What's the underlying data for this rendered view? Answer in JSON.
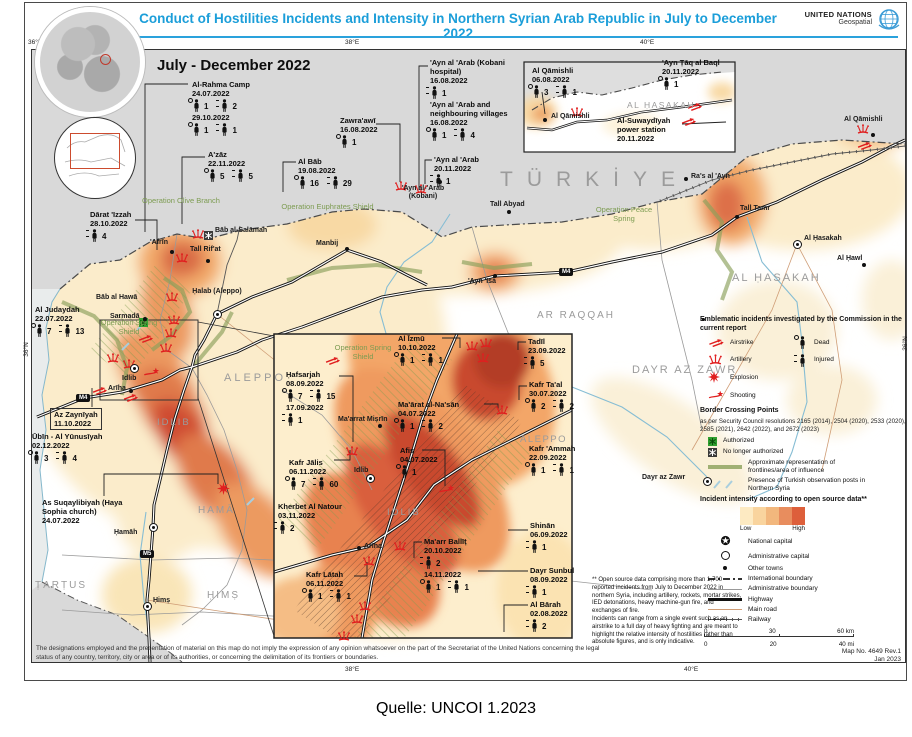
{
  "title": "Conduct of Hostilities Incidents and Intensity in Northern Syrian Arab Republic in July to December 2022",
  "brand": {
    "name": "UNITED NATIONS",
    "sub": "Geospatial"
  },
  "period": "July - December 2022",
  "caption": "Quelle: UNCOI 1.2023",
  "axis": {
    "top": [
      "36°E",
      "38°E",
      "40°E"
    ],
    "bottom": [
      "38°E",
      "40°E"
    ],
    "left": "36°N",
    "right": "36°N"
  },
  "incidents": [
    {
      "name": "Al-Rahma Camp",
      "entries": [
        {
          "date": "24.07.2022",
          "dead": "1",
          "injured": "2"
        },
        {
          "date": "29.10.2022",
          "dead": "1",
          "injured": "1"
        }
      ]
    },
    {
      "name": "A'zāz",
      "entries": [
        {
          "date": "22.11.2022",
          "dead": "5",
          "injured": "5"
        }
      ]
    },
    {
      "name": "Al Bāb",
      "entries": [
        {
          "date": "19.08.2022",
          "dead": "16",
          "injured": "29"
        }
      ]
    },
    {
      "name": "Zawra'awī",
      "entries": [
        {
          "date": "16.08.2022",
          "dead": "1"
        }
      ]
    },
    {
      "name": "'Ayn al 'Arab (Kobani hospital)",
      "entries": [
        {
          "date": "16.08.2022",
          "injured": "1"
        }
      ]
    },
    {
      "name": "'Ayn al 'Arab and neighbouring villages",
      "entries": [
        {
          "date": "16.08.2022",
          "dead": "1",
          "injured": "4"
        }
      ]
    },
    {
      "name": "'Ayn al 'Arab",
      "entries": [
        {
          "date": "20.11.2022",
          "injured": "1"
        }
      ]
    },
    {
      "name": "Dārat 'Izzah",
      "entries": [
        {
          "date": "28.10.2022",
          "injured": "4"
        }
      ]
    },
    {
      "name": "Al Judaydah",
      "entries": [
        {
          "date": "22.07.2022",
          "dead": "7",
          "injured": "13"
        }
      ]
    },
    {
      "name": "Az Zaynīyah",
      "entries": [
        {
          "date": "11.10.2022"
        }
      ]
    },
    {
      "name": "Ūbīn - Al Yūnusīyah",
      "entries": [
        {
          "date": "02.12.2022",
          "dead": "3",
          "injured": "4"
        }
      ]
    },
    {
      "name": "As Suqaylibiyah (Haya Sophia church)",
      "entries": [
        {
          "date": "24.07.2022"
        }
      ]
    },
    {
      "name": "Ḥafsarjah",
      "entries": [
        {
          "date": "08.09.2022",
          "dead": "7",
          "injured": "15"
        },
        {
          "date": "17.09.2022",
          "injured": "1"
        }
      ]
    },
    {
      "name": "Kafr Jālis",
      "entries": [
        {
          "date": "06.11.2022",
          "dead": "7",
          "injured": "60"
        }
      ]
    },
    {
      "name": "Kherbet Al Natour",
      "entries": [
        {
          "date": "03.11.2022",
          "injured": "2"
        }
      ]
    },
    {
      "name": "Kafr Lātah",
      "entries": [
        {
          "date": "06.11.2022",
          "dead": "1",
          "injured": "1"
        }
      ]
    },
    {
      "name": "Al Īzmū",
      "entries": [
        {
          "date": "10.10.2022",
          "dead": "1",
          "injured": "1"
        }
      ]
    },
    {
      "name": "Ma'ārat al-Na'sān",
      "entries": [
        {
          "date": "04.07.2022",
          "dead": "1",
          "injured": "2"
        }
      ]
    },
    {
      "name": "Afis",
      "entries": [
        {
          "date": "04.07.2022",
          "dead": "1"
        }
      ]
    },
    {
      "name": "Ma'arr Ballīṭ",
      "entries": [
        {
          "date": "20.10.2022",
          "injured": "2"
        },
        {
          "date": "14.11.2022",
          "dead": "1",
          "injured": "1"
        }
      ]
    },
    {
      "name": "Tadīl",
      "entries": [
        {
          "date": "23.09.2022",
          "injured": "5"
        }
      ]
    },
    {
      "name": "Kafr Ta'al",
      "entries": [
        {
          "date": "30.07.2022",
          "dead": "2",
          "injured": "2"
        }
      ]
    },
    {
      "name": "Kafr 'Ammah",
      "entries": [
        {
          "date": "22.09.2022",
          "dead": "1",
          "injured": "1"
        }
      ]
    },
    {
      "name": "Shinān",
      "entries": [
        {
          "date": "06.09.2022",
          "injured": "1"
        }
      ]
    },
    {
      "name": "Dayr Sunbul",
      "entries": [
        {
          "date": "08.09.2022",
          "injured": "1"
        }
      ]
    },
    {
      "name": "Al Bārah",
      "entries": [
        {
          "date": "02.08.2022",
          "injured": "2"
        }
      ]
    },
    {
      "name": "Al Qāmishli",
      "entries": [
        {
          "date": "06.08.2022",
          "dead": "3",
          "injured": "1"
        }
      ]
    },
    {
      "name": "'Ayn Ṭāq al Baql",
      "entries": [
        {
          "date": "20.11.2022",
          "dead": "1"
        }
      ]
    },
    {
      "name": "Al-Suwaydīyah power station",
      "entries": [
        {
          "date": "20.11.2022"
        }
      ]
    }
  ],
  "regions": [
    "TÜRKİYE",
    "AL ḤASAKAH",
    "AL ḤASAKAH",
    "AR RAQQAH",
    "ALEPPO",
    "ALEPPO",
    "IDLIB",
    "IDLIB",
    "DAYR AZ ZAWR",
    "HAMĀ",
    "ḤIMṢ",
    "ṬARṬUS"
  ],
  "operations": [
    "Operation Olive Branch",
    "Operation Euphrates Shield",
    "Operation Peace Spring",
    "Operation Spring Shield",
    "Operation Spring Shield"
  ],
  "towns": [
    "'Afrīn",
    "Tall Rif'at",
    "Bāb al-Salāmah",
    "Bāb al Hawā",
    "Sarmadā",
    "Ḥalab (Aleppo)",
    "Manbij",
    "Tall Abyad",
    "'Ayn 'Isá",
    "'Ayn al-'Arab (Kobani)",
    "Ra's al 'Ayn",
    "Tall Tamr",
    "Al Ḥasakah",
    "Al Ḥawl",
    "Al Qāmishli",
    "Idlib",
    "Ma'arrat Miṣrīn",
    "Idlib",
    "Arīha",
    "Arīha",
    "Ḥamāh",
    "Ḥimṣ",
    "Dayr az Zawr",
    "Al Qāmishli"
  ],
  "highways": [
    "M4",
    "M4",
    "M5"
  ],
  "legend": {
    "incidents_title": "Emblematic incidents investigated by the Commission in the current report",
    "items_left": [
      "Airstrike",
      "Artillery",
      "Explosion",
      "Shooting"
    ],
    "items_right": [
      "Dead",
      "Injured"
    ],
    "border_title": "Border Crossing Points",
    "border_note": "as per Security Council resolutions 2165 (2014), 2504 (2020), 2533 (2020), 2585 (2021), 2642 (2022), and 2672 (2023)",
    "authorized": "Authorized",
    "not_authorized": "No longer authorized",
    "frontlines": "Approximate representation of frontlines/area of influence",
    "turkish_posts": "Presence of Turkish observation posts in Northern Syria",
    "intensity_title": "Incident intensity according to open source data**",
    "low": "Low",
    "high": "High",
    "ramp_colors": [
      "#fdeac2",
      "#f9d49e",
      "#f2b77d",
      "#e88d5e",
      "#dd5f3b"
    ],
    "symbols": [
      "National capital",
      "Administrative capital",
      "Other towns",
      "International boundary",
      "Administrative boundary",
      "Highway",
      "Main road",
      "Railway"
    ],
    "scale_km": [
      "0",
      "30",
      "60 km"
    ],
    "scale_mi": [
      "0",
      "20",
      "40 mi"
    ]
  },
  "footnote": "** Open source data comprising more than 1,700 reported incidents from July to December 2022 in northern Syria, including artillery, rockets, mortar strikes, IED detonations, heavy machine-gun fire, and exchanges of fire.\nIncidents can range from a single event such as an airstrike to a full day of heavy fighting and are meant to highlight the relative intensity of hostilities rather than absolute figures, and is only indicative.",
  "disclaimer": "The designations employed and the presentation of material on this map do not imply the expression of any opinion whatsoever on the part of the Secretariat of the United Nations concerning the legal status of any country, territory, city or area or of its authorities, or concerning the delimitation of its frontiers or boundaries.",
  "mapno": "Map No. 4649 Rev.1",
  "mapdate": "Jan 2023"
}
